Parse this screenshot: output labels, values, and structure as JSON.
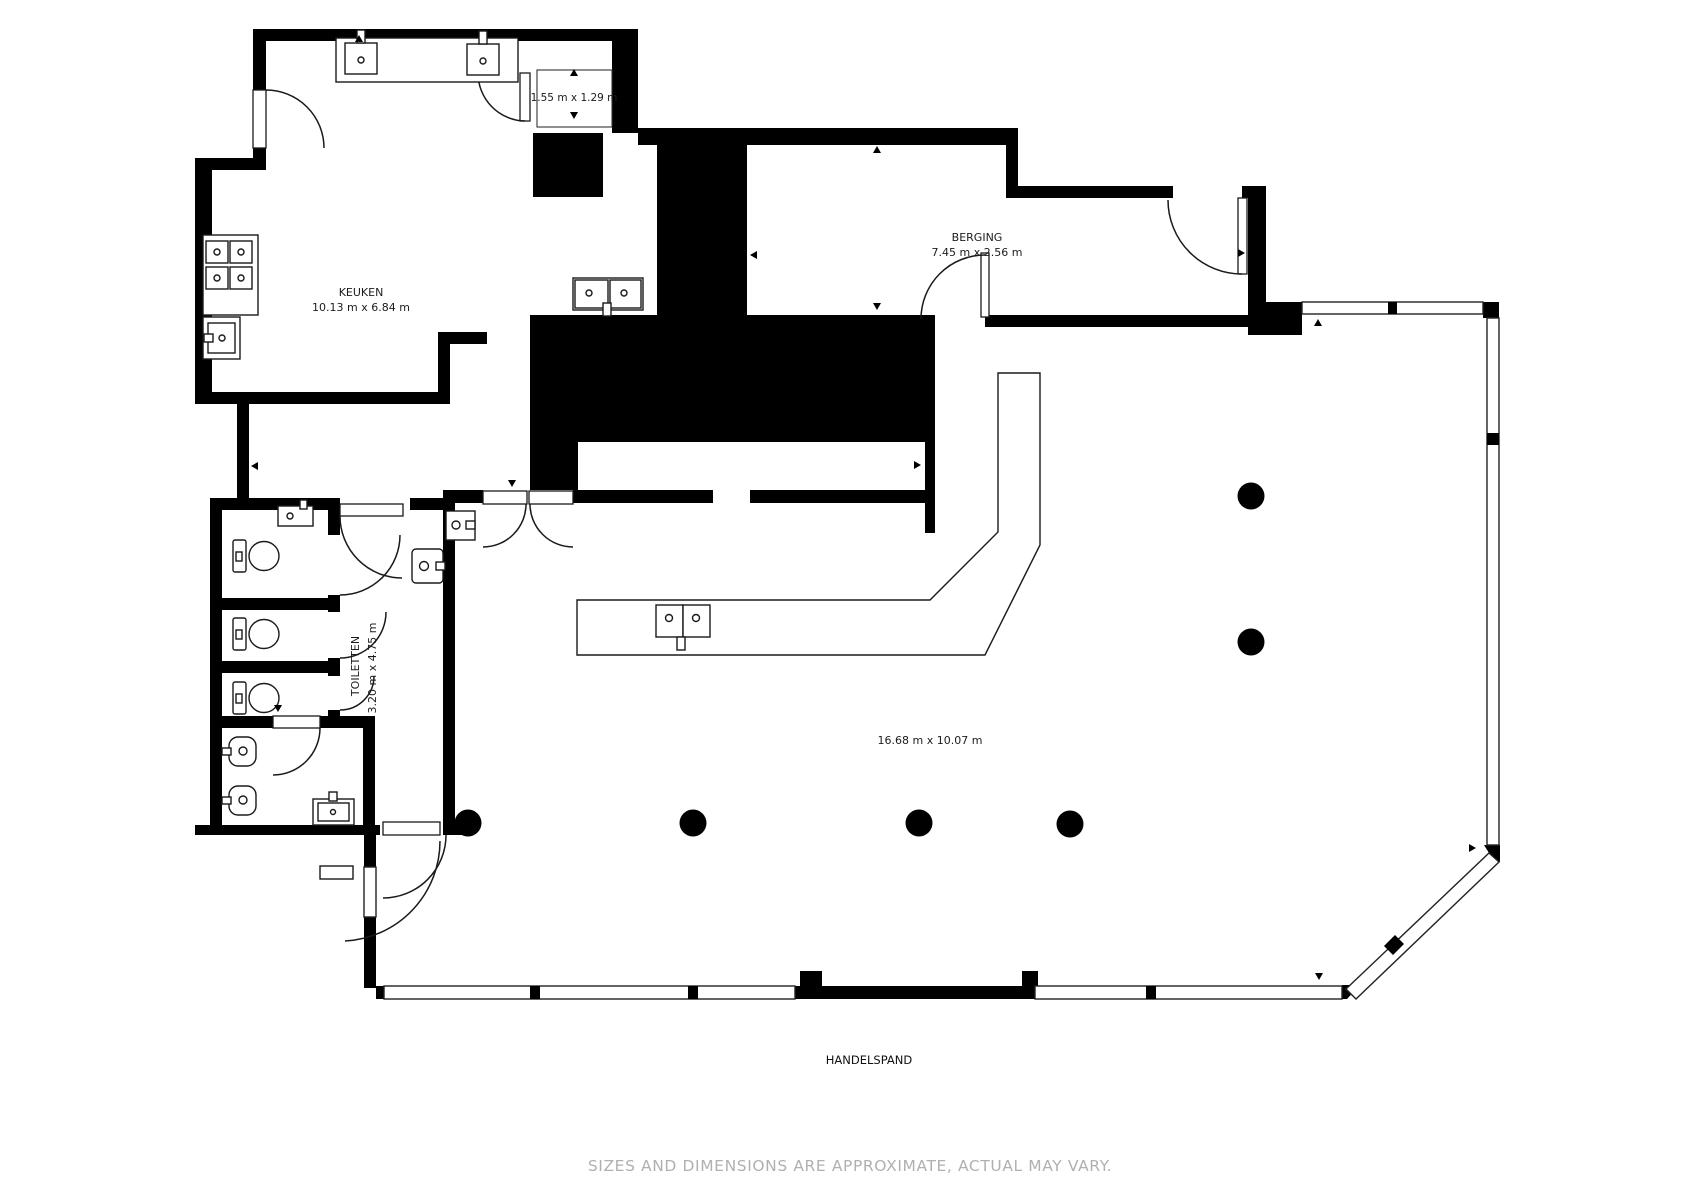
{
  "page": {
    "background": "#ffffff",
    "wall_color": "#000000",
    "line_color": "#1a1a1a",
    "muted_text_color": "#b0b0b0"
  },
  "plan": {
    "building_label": "HANDELSPAND",
    "rooms": {
      "keuken": {
        "name": "KEUKEN",
        "dimensions": "10.13 m x 6.84 m"
      },
      "berging": {
        "name": "BERGING",
        "dimensions": "7.45 m x 2.56 m"
      },
      "toiletten": {
        "name": "TOILETTEN",
        "dimensions": "3.20 m x 4.75 m"
      },
      "storage_nook": {
        "dimensions": "1.55 m x 1.29 m"
      },
      "main_hall": {
        "dimensions": "16.68 m x 10.07 m"
      }
    }
  },
  "footer": {
    "disclaimer": "SIZES AND DIMENSIONS ARE APPROXIMATE, ACTUAL MAY VARY."
  }
}
